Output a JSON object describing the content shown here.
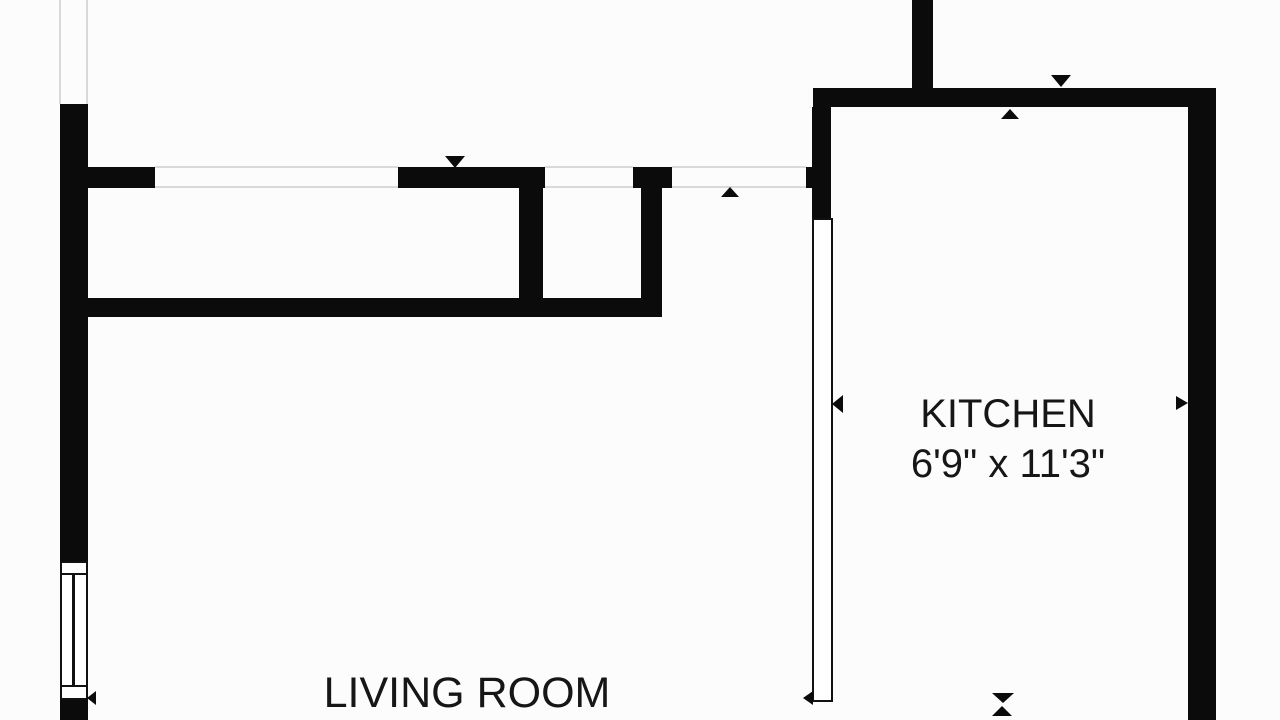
{
  "title": "Apartment floor plan",
  "colors": {
    "wall": "#0b0b0b",
    "background": "#fcfcfc",
    "opening_line": "#d9d9d9",
    "text": "#161616",
    "fixture_fill": "#ffffff",
    "fixture_border": "#111111"
  },
  "rooms": {
    "kitchen": {
      "name": "KITCHEN",
      "dimensions": "6'9\" x 11'3\""
    },
    "living_room": {
      "name": "LIVING ROOM"
    }
  },
  "walls": [
    {
      "name": "left-wall-upper",
      "x": 60,
      "y": 104,
      "w": 28,
      "h": 457
    },
    {
      "name": "left-wall-lower",
      "x": 60,
      "y": 700,
      "w": 28,
      "h": 20
    },
    {
      "name": "hall-stub-left",
      "x": 88,
      "y": 167,
      "w": 67,
      "h": 21
    },
    {
      "name": "hall-wall-a",
      "x": 398,
      "y": 167,
      "w": 147,
      "h": 21
    },
    {
      "name": "closet-wall-left",
      "x": 519,
      "y": 188,
      "w": 24,
      "h": 110
    },
    {
      "name": "hall-wall-bottom",
      "x": 85,
      "y": 298,
      "w": 575,
      "h": 19
    },
    {
      "name": "closet-wall-right-top",
      "x": 633,
      "y": 167,
      "w": 39,
      "h": 21
    },
    {
      "name": "closet-wall-right",
      "x": 641,
      "y": 188,
      "w": 21,
      "h": 129
    },
    {
      "name": "kitchen-wall-top",
      "x": 813,
      "y": 88,
      "w": 403,
      "h": 19
    },
    {
      "name": "top-wall-stub",
      "x": 912,
      "y": 0,
      "w": 21,
      "h": 88
    },
    {
      "name": "kitchen-wall-left-upper",
      "x": 812,
      "y": 107,
      "w": 19,
      "h": 111
    },
    {
      "name": "kitchen-door-jamb",
      "x": 806,
      "y": 167,
      "w": 6,
      "h": 21
    },
    {
      "name": "right-wall",
      "x": 1188,
      "y": 88,
      "w": 28,
      "h": 632
    }
  ],
  "opening_lines": [
    {
      "name": "entry-opening-line-left",
      "x": 59,
      "y": 0,
      "w": 2,
      "h": 104
    },
    {
      "name": "entry-opening-line-right",
      "x": 86,
      "y": 0,
      "w": 2,
      "h": 104
    },
    {
      "name": "opening-a-top-line",
      "x": 155,
      "y": 166,
      "w": 243,
      "h": 2
    },
    {
      "name": "opening-a-bottom-line",
      "x": 155,
      "y": 186,
      "w": 243,
      "h": 2
    },
    {
      "name": "opening-b-top-line",
      "x": 545,
      "y": 166,
      "w": 88,
      "h": 2
    },
    {
      "name": "opening-b-bottom-line",
      "x": 545,
      "y": 186,
      "w": 88,
      "h": 2
    },
    {
      "name": "opening-c-top-line",
      "x": 672,
      "y": 166,
      "w": 134,
      "h": 2
    },
    {
      "name": "opening-c-bottom-line",
      "x": 672,
      "y": 186,
      "w": 134,
      "h": 2
    }
  ],
  "window": {
    "name": "window-symbol",
    "x": 60,
    "y": 561,
    "w": 28,
    "h": 139,
    "divider_top_offset": 12,
    "divider_bottom_offset": 124,
    "center_line_offset": 12
  },
  "door_panel": {
    "name": "kitchen-door-panel",
    "x": 812,
    "y": 218,
    "w": 21,
    "h": 484
  },
  "markers": [
    {
      "name": "arrow-down-hall-opening",
      "dir": "down",
      "x": 445,
      "y": 156,
      "w": 20,
      "h": 12
    },
    {
      "name": "arrow-up-hall-opening",
      "dir": "up",
      "x": 721,
      "y": 187,
      "w": 18,
      "h": 10
    },
    {
      "name": "arrow-down-kitchen-top",
      "dir": "down",
      "x": 1051,
      "y": 75,
      "w": 20,
      "h": 12
    },
    {
      "name": "arrow-up-kitchen-top",
      "dir": "up",
      "x": 1001,
      "y": 109,
      "w": 18,
      "h": 10
    },
    {
      "name": "arrow-left-kitchen-door",
      "dir": "left",
      "x": 832,
      "y": 395,
      "w": 11,
      "h": 18
    },
    {
      "name": "arrow-right-kitchen-wall",
      "dir": "right",
      "x": 1176,
      "y": 396,
      "w": 12,
      "h": 15
    },
    {
      "name": "arrow-left-window-bottom",
      "dir": "left",
      "x": 87,
      "y": 691,
      "w": 9,
      "h": 14
    },
    {
      "name": "arrow-left-door-bottom",
      "dir": "left",
      "x": 803,
      "y": 691,
      "w": 10,
      "h": 14
    },
    {
      "name": "arrow-down-kitchen-bottom",
      "dir": "down",
      "x": 992,
      "y": 693,
      "w": 23,
      "h": 10
    },
    {
      "name": "arrow-up-kitchen-bottom",
      "dir": "up",
      "x": 992,
      "y": 706,
      "w": 20,
      "h": 10
    }
  ]
}
